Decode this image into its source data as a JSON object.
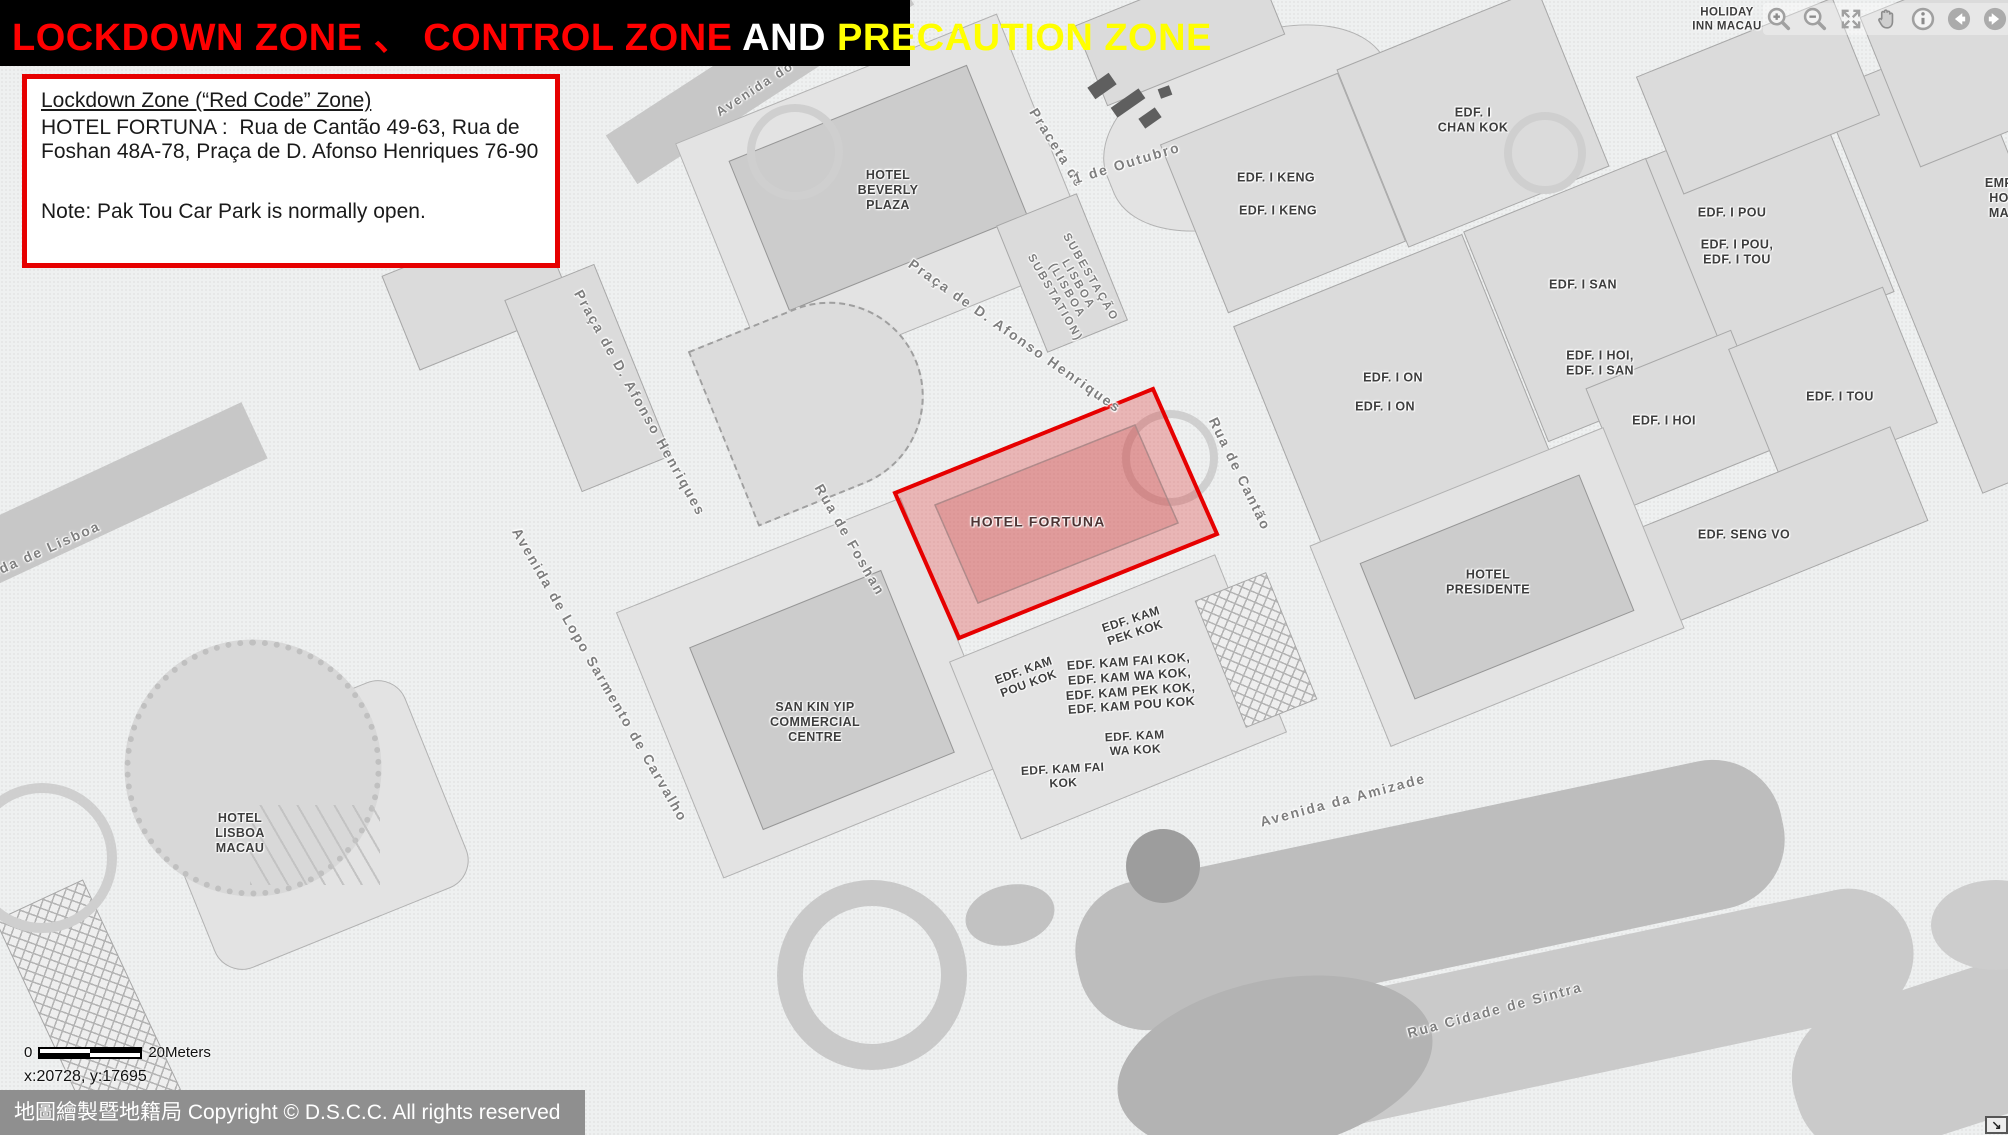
{
  "title": {
    "segments": [
      {
        "text": "LOCKDOWN ZONE 、 CONTROL ZONE",
        "color": "#ff0000"
      },
      {
        "text": " AND ",
        "color": "#ffffff"
      },
      {
        "text": "PRECAUTION ZONE",
        "color": "#ffff00"
      }
    ]
  },
  "info_box": {
    "heading": "Lockdown Zone (“Red Code” Zone)",
    "body": "HOTEL FORTUNA :  Rua de Cantão 49-63, Rua de Foshan 48A-78, Praça de D. Afonso Henriques 76-90",
    "note": "Note: Pak Tou Car Park is normally open."
  },
  "toolbar": {
    "icons": [
      "zoom-in-icon",
      "zoom-out-icon",
      "full-extent-icon",
      "pan-icon",
      "info-icon",
      "previous-extent-icon",
      "next-extent-icon"
    ]
  },
  "map": {
    "zone": {
      "name": "HOTEL FORTUNA",
      "border_color": "#e60000",
      "fill_color": "rgba(225,60,60,0.32)",
      "outer_points": "895,493 1153,389 1217,534 959,638",
      "inner_points": "935,505 1135,425 1178,523 978,603",
      "inner_fill": "rgba(200,85,85,0.28)",
      "inner_stroke": "#b08a8a"
    },
    "street_labels": [
      {
        "text": "Avenida do D",
        "x": 762,
        "y": 84,
        "rot": -33,
        "size": 13
      },
      {
        "text": "Praceta de",
        "x": 1057,
        "y": 148,
        "rot": 58
      },
      {
        "text": "1 de Outubro",
        "x": 1127,
        "y": 163,
        "rot": -17
      },
      {
        "text": "Praça de D. Afonso Henriques",
        "x": 1015,
        "y": 336,
        "rot": 35
      },
      {
        "text": "Praça de D. Afonso Henriques",
        "x": 640,
        "y": 403,
        "rot": 61
      },
      {
        "text": "Rua de Cantão",
        "x": 1240,
        "y": 474,
        "rot": 64
      },
      {
        "text": "Rua de Foshan",
        "x": 850,
        "y": 540,
        "rot": 60
      },
      {
        "text": "Avenida de Lopo Sarmento de Carvalho",
        "x": 600,
        "y": 675,
        "rot": 60
      },
      {
        "text": "Avenida da Amizade",
        "x": 1343,
        "y": 800,
        "rot": -15
      },
      {
        "text": "Rua Cidade de Sintra",
        "x": 1495,
        "y": 1010,
        "rot": -15
      },
      {
        "text": "Avenida de Lisboa",
        "x": 28,
        "y": 557,
        "rot": -24
      },
      {
        "text": "SUBESTAÇÃO\nLISBOA\n(LISBOA\nSUBSTATION)",
        "x": 1072,
        "y": 288,
        "rot": 60,
        "size": 11.5
      }
    ],
    "building_labels": [
      {
        "text": "HOTEL\nBEVERLY\nPLAZA",
        "x": 888,
        "y": 190
      },
      {
        "text": "EDF. I\nCHAN KOK",
        "x": 1473,
        "y": 120
      },
      {
        "text": "EDF. I KENG",
        "x": 1276,
        "y": 178
      },
      {
        "text": "EDF. I KENG",
        "x": 1278,
        "y": 211
      },
      {
        "text": "EDF. I POU",
        "x": 1732,
        "y": 213
      },
      {
        "text": "EDF. I POU,\nEDF. I TOU",
        "x": 1737,
        "y": 252
      },
      {
        "text": "EDF. I SAN",
        "x": 1583,
        "y": 285
      },
      {
        "text": "EDF. I HOI,\nEDF. I SAN",
        "x": 1600,
        "y": 363
      },
      {
        "text": "EDF. I ON",
        "x": 1393,
        "y": 378
      },
      {
        "text": "EDF. I ON",
        "x": 1385,
        "y": 407
      },
      {
        "text": "EDF. I HOI",
        "x": 1664,
        "y": 421
      },
      {
        "text": "EDF. I TOU",
        "x": 1840,
        "y": 397
      },
      {
        "text": "EDF. SENG VO",
        "x": 1744,
        "y": 535
      },
      {
        "text": "HOTEL\nPRESIDENTE",
        "x": 1488,
        "y": 582
      },
      {
        "text": "SAN KIN YIP\nCOMMERCIAL\nCENTRE",
        "x": 815,
        "y": 722
      },
      {
        "text": "HOTEL\nLISBOA\nMACAU",
        "x": 240,
        "y": 833
      },
      {
        "text": "HOLIDAY\nINN MACAU",
        "x": 1727,
        "y": 20,
        "size": 11.5
      },
      {
        "text": "EDF. KAM\nPEK KOK",
        "x": 1133,
        "y": 626,
        "rot": -18,
        "size": 12
      },
      {
        "text": "EDF. KAM\nPOU KOK",
        "x": 1026,
        "y": 677,
        "rot": -20,
        "size": 12
      },
      {
        "text": "EDF. KAM FAI KOK,\nEDF. KAM WA KOK,\nEDF. KAM PEK KOK,\nEDF. KAM POU KOK",
        "x": 1130,
        "y": 684,
        "rot": -4,
        "size": 12.5
      },
      {
        "text": "EDF. KAM\nWA KOK",
        "x": 1135,
        "y": 743,
        "rot": -3,
        "size": 12
      },
      {
        "text": "EDF. KAM FAI\nKOK",
        "x": 1063,
        "y": 776,
        "rot": -3,
        "size": 12
      },
      {
        "text": "EMP\nHO\nMA",
        "x": 1999,
        "y": 198
      },
      {
        "text": "HOTEL FORTUNA",
        "x": 1038,
        "y": 522,
        "cls": "zone"
      }
    ]
  },
  "scale_bar": {
    "left_label": "0",
    "right_label": "20Meters"
  },
  "status": {
    "coordinates": "x:20728, y:17695"
  },
  "footer": {
    "copyright": "地圖繪製暨地籍局 Copyright © D.S.C.C. All rights reserved"
  },
  "corner_button": {
    "glyph": "↘"
  }
}
